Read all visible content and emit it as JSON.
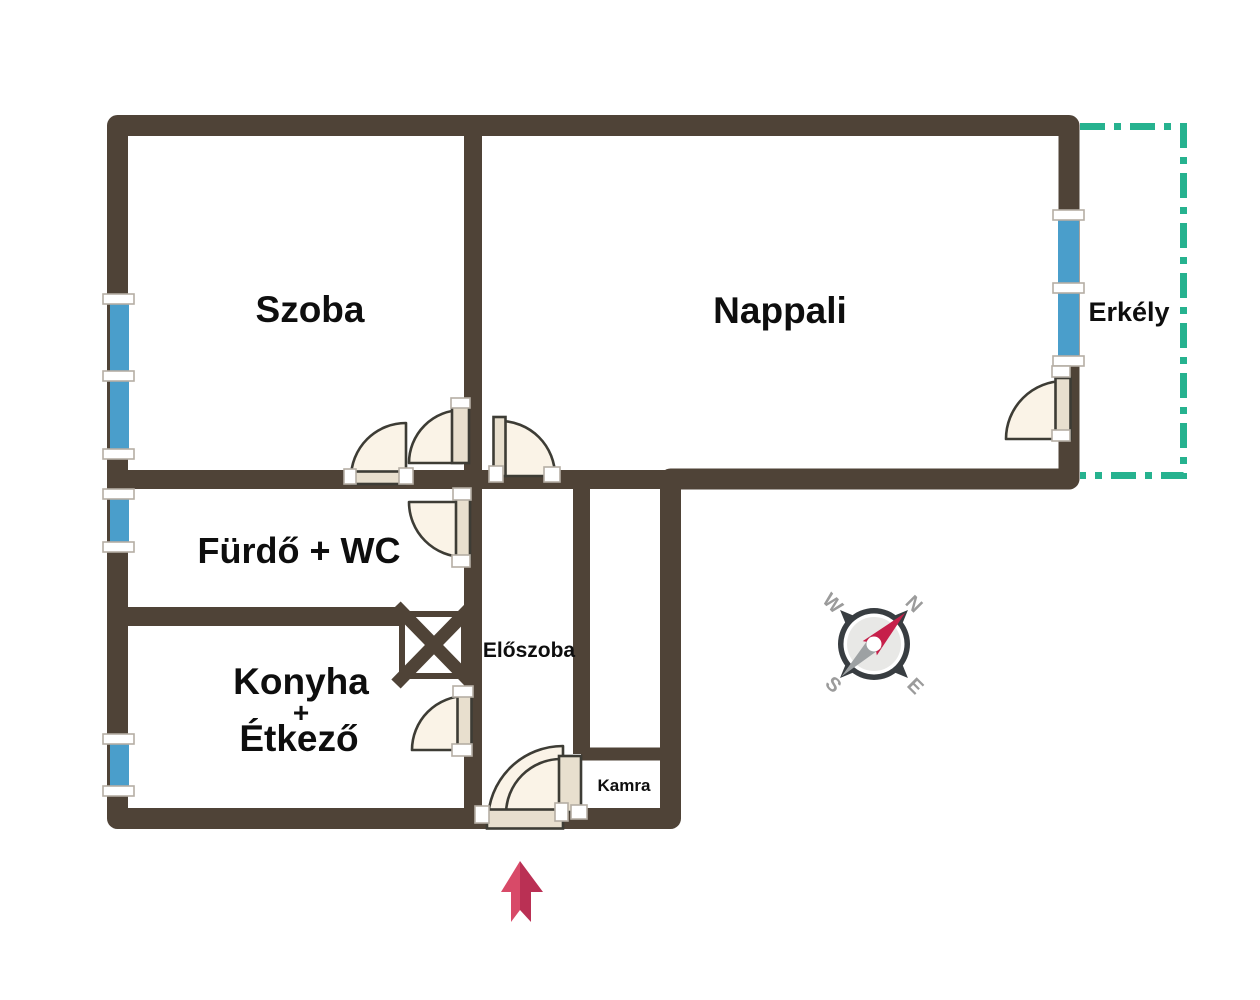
{
  "plan": {
    "rooms": {
      "szoba": {
        "label": "Szoba"
      },
      "nappali": {
        "label": "Nappali"
      },
      "erkely": {
        "label": "Erkély"
      },
      "furdo": {
        "label": "Fürdő + WC"
      },
      "konyha": {
        "lines": [
          "Konyha",
          "+",
          "Étkező"
        ]
      },
      "eloszoba": {
        "label": "Előszoba"
      },
      "kamra": {
        "label": "Kamra"
      }
    },
    "compass": {
      "n": "N",
      "e": "E",
      "s": "S",
      "w": "W"
    },
    "icons": {
      "compass": "compass-rose",
      "entrance_arrow": "arrow-up",
      "shaft": "x-box-shaft-symbol",
      "door": "quarter-circle-door-swing",
      "window": "blue-window-strip"
    },
    "colors": {
      "wall": "#4f4337",
      "window": "#4a9ecb",
      "balcony": "#26b28f",
      "door_fill": "#faf3e7",
      "door_leaf": "#e8dfce",
      "door_stroke": "#3d3c35",
      "text": "#0e0e0e",
      "compass_body": "#383d41",
      "compass_face": "#e8e8e6",
      "compass_letter": "#9b9b9b",
      "needle": "#c6204a",
      "needle_tail": "#9da1a3",
      "arrow_left": "#d84a68",
      "arrow_right": "#ba3054"
    }
  }
}
